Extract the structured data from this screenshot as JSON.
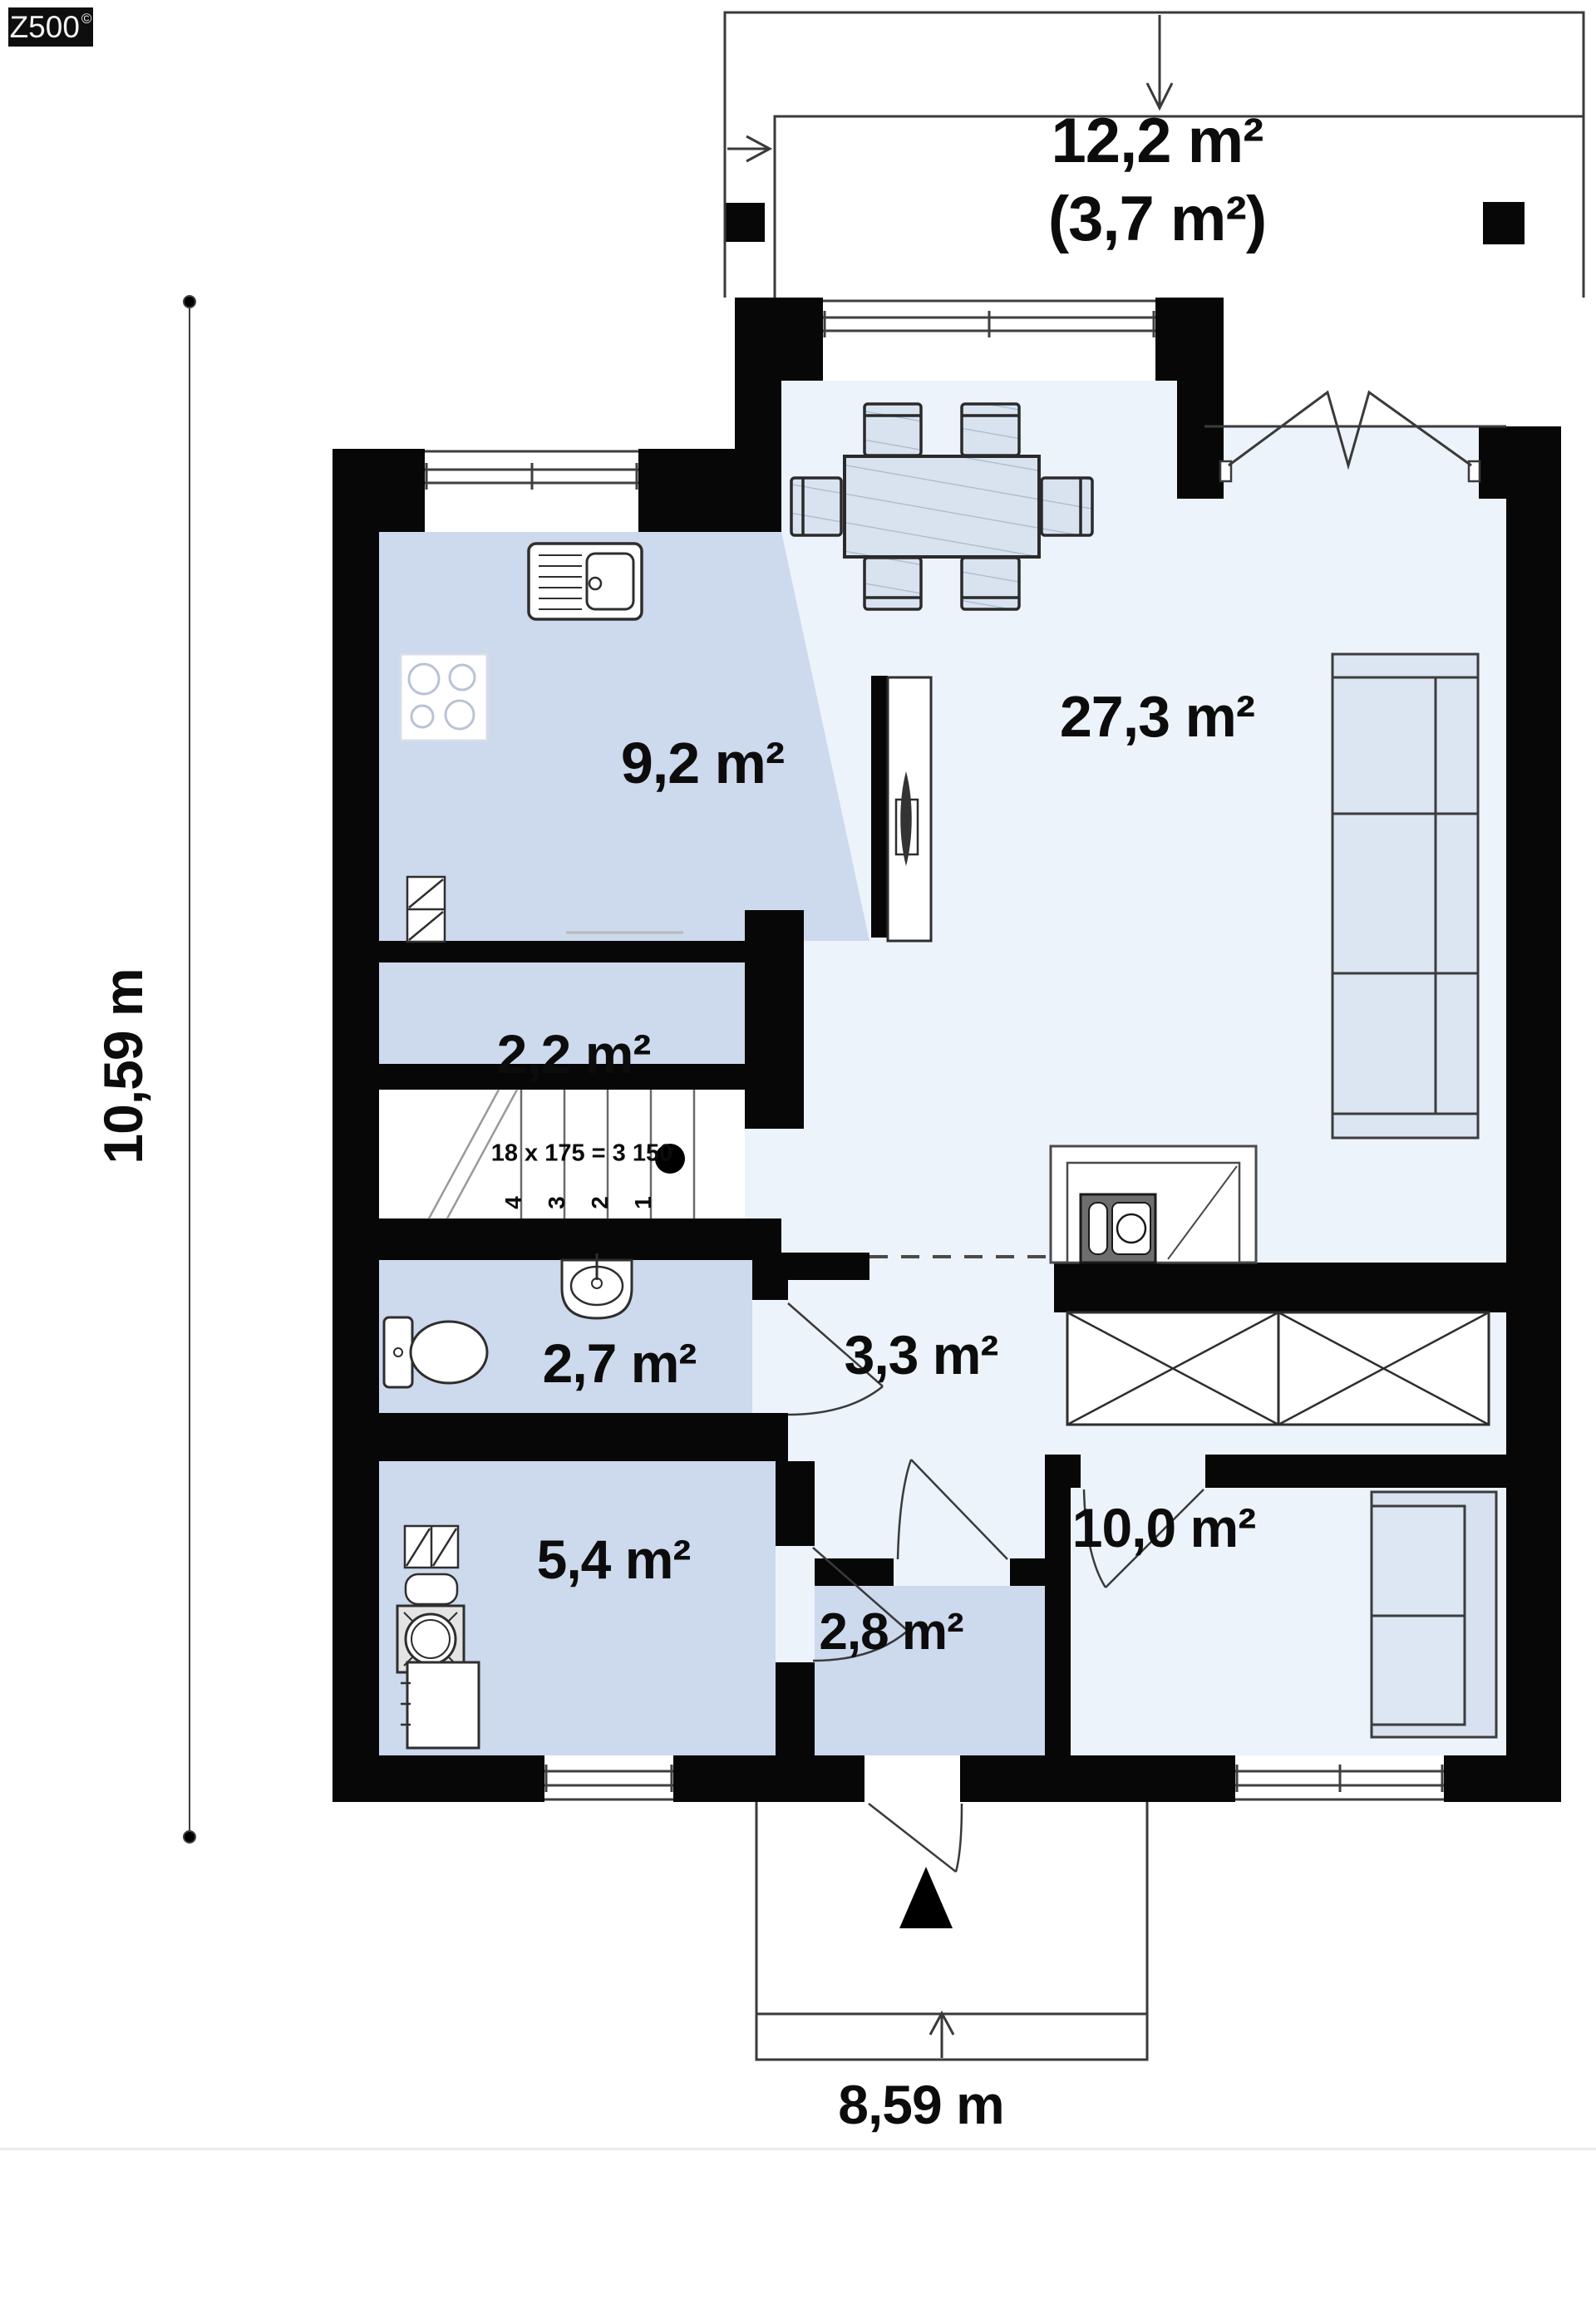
{
  "brand": {
    "logo_text": "Z500",
    "logo_mark": "©"
  },
  "terrace": {
    "area_label": "12,2 m²",
    "area_sublabel": "(3,7 m²)"
  },
  "rooms": {
    "kitchen": "9,2 m²",
    "living": "27,3 m²",
    "pantry": "2,2 m²",
    "bathroom": "2,7 m²",
    "hall": "3,3 m²",
    "utility": "5,4 m²",
    "vestibule": "2,8 m²",
    "bedroom": "10,0 m²"
  },
  "stairs": {
    "annotation": "18 x 175 = 3 150",
    "steps": [
      "4",
      "3",
      "2",
      "1"
    ]
  },
  "dimensions": {
    "height_label": "10,59 m",
    "width_label": "8,59 m"
  },
  "colors": {
    "wall": "#070707",
    "floor_light": "#ecf3fa",
    "floor_medium": "#cdd9ec",
    "furniture_fill": "#d9e3f0"
  }
}
